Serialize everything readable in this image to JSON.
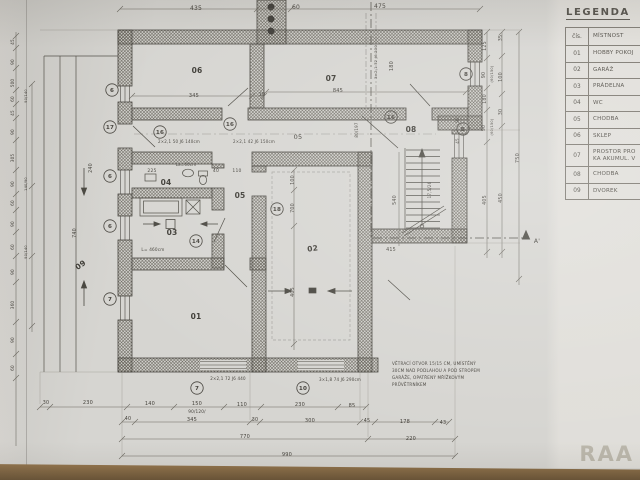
{
  "meta": {
    "watermark": "RAA"
  },
  "colors": {
    "paper": "#d6d5d1",
    "paper_light": "#e0ded9",
    "ink": "#45423c",
    "desk_brown": "#8a6c48",
    "watermark_gray": "#97917f"
  },
  "legend": {
    "title": "LEGENDA",
    "columns": [
      "čís.",
      "MÍSTNOST"
    ],
    "rows": [
      {
        "num": "01",
        "name": "HOBBY POKOJ"
      },
      {
        "num": "02",
        "name": "GARÁŽ"
      },
      {
        "num": "03",
        "name": "PRÁDELNA"
      },
      {
        "num": "04",
        "name": "WC"
      },
      {
        "num": "05",
        "name": "CHODBA"
      },
      {
        "num": "06",
        "name": "SKLEP"
      },
      {
        "num": "07",
        "name": "PROSTOR PRO\nKA AKUMUL. V"
      },
      {
        "num": "08",
        "name": "CHODBA"
      },
      {
        "num": "09",
        "name": "DVOREK"
      }
    ]
  },
  "plan": {
    "section_label": "A'",
    "room_labels": [
      {
        "id": "01",
        "x": 196,
        "y": 319
      },
      {
        "id": "02",
        "x": 313,
        "y": 251,
        "r": -8
      },
      {
        "id": "03",
        "x": 172,
        "y": 235
      },
      {
        "id": "04",
        "x": 166,
        "y": 185
      },
      {
        "id": "05",
        "x": 240,
        "y": 198
      },
      {
        "id": "06",
        "x": 197,
        "y": 73
      },
      {
        "id": "07",
        "x": 331,
        "y": 81
      },
      {
        "id": "08",
        "x": 411,
        "y": 132
      },
      {
        "id": "09",
        "x": 82,
        "y": 267,
        "r": -35
      }
    ],
    "markers": [
      {
        "t": "6",
        "x": 112,
        "y": 90
      },
      {
        "t": "17",
        "x": 110,
        "y": 127
      },
      {
        "t": "6",
        "x": 110,
        "y": 176
      },
      {
        "t": "6",
        "x": 110,
        "y": 226
      },
      {
        "t": "7",
        "x": 110,
        "y": 299
      },
      {
        "t": "7",
        "x": 197,
        "y": 388
      },
      {
        "t": "10",
        "x": 303,
        "y": 388
      },
      {
        "t": "8",
        "x": 466,
        "y": 74
      },
      {
        "t": "B",
        "x": 463,
        "y": 129
      },
      {
        "t": "16",
        "x": 391,
        "y": 117
      },
      {
        "t": "16",
        "x": 230,
        "y": 124
      },
      {
        "t": "16",
        "x": 160,
        "y": 132
      },
      {
        "t": "14",
        "x": 196,
        "y": 241
      },
      {
        "t": "18",
        "x": 277,
        "y": 209
      }
    ],
    "texts": [
      {
        "t": "435",
        "x": 196,
        "y": 10,
        "s": 6
      },
      {
        "t": "60",
        "x": 296,
        "y": 9,
        "s": 6
      },
      {
        "t": "475",
        "x": 380,
        "y": 8,
        "s": 6
      },
      {
        "t": "345",
        "x": 194,
        "y": 97,
        "s": 5
      },
      {
        "t": "10",
        "x": 262,
        "y": 96,
        "s": 5
      },
      {
        "t": "845",
        "x": 338,
        "y": 92,
        "s": 5
      },
      {
        "t": "180",
        "x": 393,
        "y": 66,
        "r": -90,
        "s": 5
      },
      {
        "t": "3×2,1 72 J6 230",
        "x": 377,
        "y": 62,
        "r": -90,
        "s": 3.8
      },
      {
        "t": "2×2,1 50 J6 140cm",
        "x": 179,
        "y": 143,
        "s": 4
      },
      {
        "t": "2×2,1 42 J6 150cm",
        "x": 254,
        "y": 143,
        "s": 4
      },
      {
        "t": "05",
        "x": 298,
        "y": 139,
        "s": 6.5,
        "n": "room-label-05-alt"
      },
      {
        "t": "80/197",
        "x": 358,
        "y": 130,
        "r": -90,
        "s": 4
      },
      {
        "t": "225",
        "x": 152,
        "y": 172,
        "s": 4.5
      },
      {
        "t": "40",
        "x": 216,
        "y": 172,
        "s": 4.5
      },
      {
        "t": "110",
        "x": 237,
        "y": 172,
        "s": 4.5
      },
      {
        "t": "La=60cm",
        "x": 186,
        "y": 166,
        "s": 4
      },
      {
        "t": "L= 460cm",
        "x": 153,
        "y": 251,
        "s": 4.2
      },
      {
        "t": "100",
        "x": 294,
        "y": 180,
        "r": -90,
        "s": 4.8
      },
      {
        "t": "700",
        "x": 294,
        "y": 208,
        "r": -90,
        "s": 4.8
      },
      {
        "t": "405",
        "x": 294,
        "y": 292,
        "r": -90,
        "s": 4.8
      },
      {
        "t": "540",
        "x": 396,
        "y": 200,
        "r": -90,
        "s": 4.8
      },
      {
        "t": "415",
        "x": 391,
        "y": 251,
        "s": 4.8
      },
      {
        "t": "17,5/26",
        "x": 431,
        "y": 190,
        "r": -90,
        "s": 4
      },
      {
        "t": "90",
        "x": 459,
        "y": 120,
        "r": -90,
        "s": 4
      },
      {
        "t": "45",
        "x": 459,
        "y": 141,
        "r": -90,
        "s": 4
      },
      {
        "t": "125",
        "x": 486,
        "y": 46,
        "r": -90,
        "s": 4.8
      },
      {
        "t": "90",
        "x": 485,
        "y": 75,
        "r": -90,
        "s": 4.8
      },
      {
        "t": "(60/150)",
        "x": 493,
        "y": 74,
        "r": -90,
        "s": 3.6
      },
      {
        "t": "180",
        "x": 486,
        "y": 99,
        "r": -90,
        "s": 4.8
      },
      {
        "t": "90",
        "x": 485,
        "y": 128,
        "r": -90,
        "s": 4.8
      },
      {
        "t": "(60/150)",
        "x": 493,
        "y": 127,
        "r": -90,
        "s": 3.6
      },
      {
        "t": "405",
        "x": 486,
        "y": 200,
        "r": -90,
        "s": 4.8
      },
      {
        "t": "35",
        "x": 502,
        "y": 38,
        "r": -90,
        "s": 4.8
      },
      {
        "t": "100",
        "x": 502,
        "y": 77,
        "r": -90,
        "s": 4.8
      },
      {
        "t": "30",
        "x": 502,
        "y": 112,
        "r": -90,
        "s": 4.8
      },
      {
        "t": "450",
        "x": 502,
        "y": 198,
        "r": -90,
        "s": 4.8
      },
      {
        "t": "750",
        "x": 519,
        "y": 158,
        "r": -90,
        "s": 5
      },
      {
        "t": "45",
        "x": 14,
        "y": 42,
        "r": -90,
        "s": 4.2
      },
      {
        "t": "90",
        "x": 14,
        "y": 62,
        "r": -90,
        "s": 4.2
      },
      {
        "t": "500",
        "x": 14,
        "y": 83,
        "r": -90,
        "s": 4.2
      },
      {
        "t": "60",
        "x": 14,
        "y": 99,
        "r": -90,
        "s": 4.2
      },
      {
        "t": "90/140",
        "x": 27,
        "y": 96,
        "r": -90,
        "s": 3.6
      },
      {
        "t": "45",
        "x": 14,
        "y": 113,
        "r": -90,
        "s": 4.2
      },
      {
        "t": "90",
        "x": 14,
        "y": 132,
        "r": -90,
        "s": 4.2
      },
      {
        "t": "305",
        "x": 14,
        "y": 158,
        "r": -90,
        "s": 4.2
      },
      {
        "t": "90",
        "x": 14,
        "y": 184,
        "r": -90,
        "s": 4.2
      },
      {
        "t": "140/90",
        "x": 27,
        "y": 184,
        "r": -90,
        "s": 3.6
      },
      {
        "t": "60",
        "x": 14,
        "y": 203,
        "r": -90,
        "s": 4.2
      },
      {
        "t": "90",
        "x": 14,
        "y": 224,
        "r": -90,
        "s": 4.2
      },
      {
        "t": "60",
        "x": 14,
        "y": 247,
        "r": -90,
        "s": 4.2
      },
      {
        "t": "90/140",
        "x": 27,
        "y": 252,
        "r": -90,
        "s": 3.6
      },
      {
        "t": "90",
        "x": 14,
        "y": 272,
        "r": -90,
        "s": 4.2
      },
      {
        "t": "360",
        "x": 14,
        "y": 305,
        "r": -90,
        "s": 4.2
      },
      {
        "t": "90",
        "x": 14,
        "y": 340,
        "r": -90,
        "s": 4.2
      },
      {
        "t": "60",
        "x": 14,
        "y": 368,
        "r": -90,
        "s": 4.2
      },
      {
        "t": "740",
        "x": 76,
        "y": 233,
        "r": -90,
        "s": 4.8
      },
      {
        "t": "240",
        "x": 92,
        "y": 168,
        "r": -90,
        "s": 4.8
      },
      {
        "t": "2×2,1 72 J6 440",
        "x": 228,
        "y": 380,
        "s": 4
      },
      {
        "t": "3×1,8 74 J6 290cm",
        "x": 340,
        "y": 381,
        "s": 4
      },
      {
        "t": "30",
        "x": 46,
        "y": 404,
        "s": 4.8
      },
      {
        "t": "230",
        "x": 88,
        "y": 404,
        "s": 5
      },
      {
        "t": "140",
        "x": 150,
        "y": 405,
        "s": 5
      },
      {
        "t": "150",
        "x": 197,
        "y": 405,
        "s": 5
      },
      {
        "t": "90/120/",
        "x": 197,
        "y": 413,
        "s": 4.2
      },
      {
        "t": "110",
        "x": 242,
        "y": 406,
        "s": 5
      },
      {
        "t": "230",
        "x": 300,
        "y": 406,
        "s": 5
      },
      {
        "t": "85",
        "x": 352,
        "y": 407,
        "s": 5
      },
      {
        "t": "40",
        "x": 128,
        "y": 420,
        "s": 4.8
      },
      {
        "t": "345",
        "x": 192,
        "y": 421,
        "s": 5
      },
      {
        "t": "30",
        "x": 255,
        "y": 421,
        "s": 4.8
      },
      {
        "t": "300",
        "x": 310,
        "y": 422,
        "s": 5
      },
      {
        "t": "45",
        "x": 367,
        "y": 422,
        "s": 4.8
      },
      {
        "t": "178",
        "x": 405,
        "y": 423,
        "s": 5
      },
      {
        "t": "43",
        "x": 443,
        "y": 424,
        "s": 4.8
      },
      {
        "t": "770",
        "x": 245,
        "y": 438,
        "s": 5
      },
      {
        "t": "220",
        "x": 411,
        "y": 440,
        "s": 5
      },
      {
        "t": "990",
        "x": 287,
        "y": 456,
        "s": 5
      },
      {
        "t": "VĚTRACÍ OTVOR 15/15 CM, UMÍSTĚNÝ",
        "x": 392,
        "y": 365,
        "s": 4.1,
        "a": "start",
        "n": "note-line"
      },
      {
        "t": "30CM NAD PODLAHOU A POD STROPEM",
        "x": 392,
        "y": 372,
        "s": 4.1,
        "a": "start",
        "n": "note-line"
      },
      {
        "t": "GARÁŽE, OPATŘENÝ MŘÍŽKOVÝM",
        "x": 392,
        "y": 379,
        "s": 4.1,
        "a": "start",
        "n": "note-line"
      },
      {
        "t": "PRŮVĚTRNÍKEM",
        "x": 392,
        "y": 386,
        "s": 4.1,
        "a": "start",
        "n": "note-line"
      },
      {
        "t": "A'",
        "x": 537,
        "y": 243,
        "s": 6,
        "n": "section-label"
      }
    ]
  }
}
